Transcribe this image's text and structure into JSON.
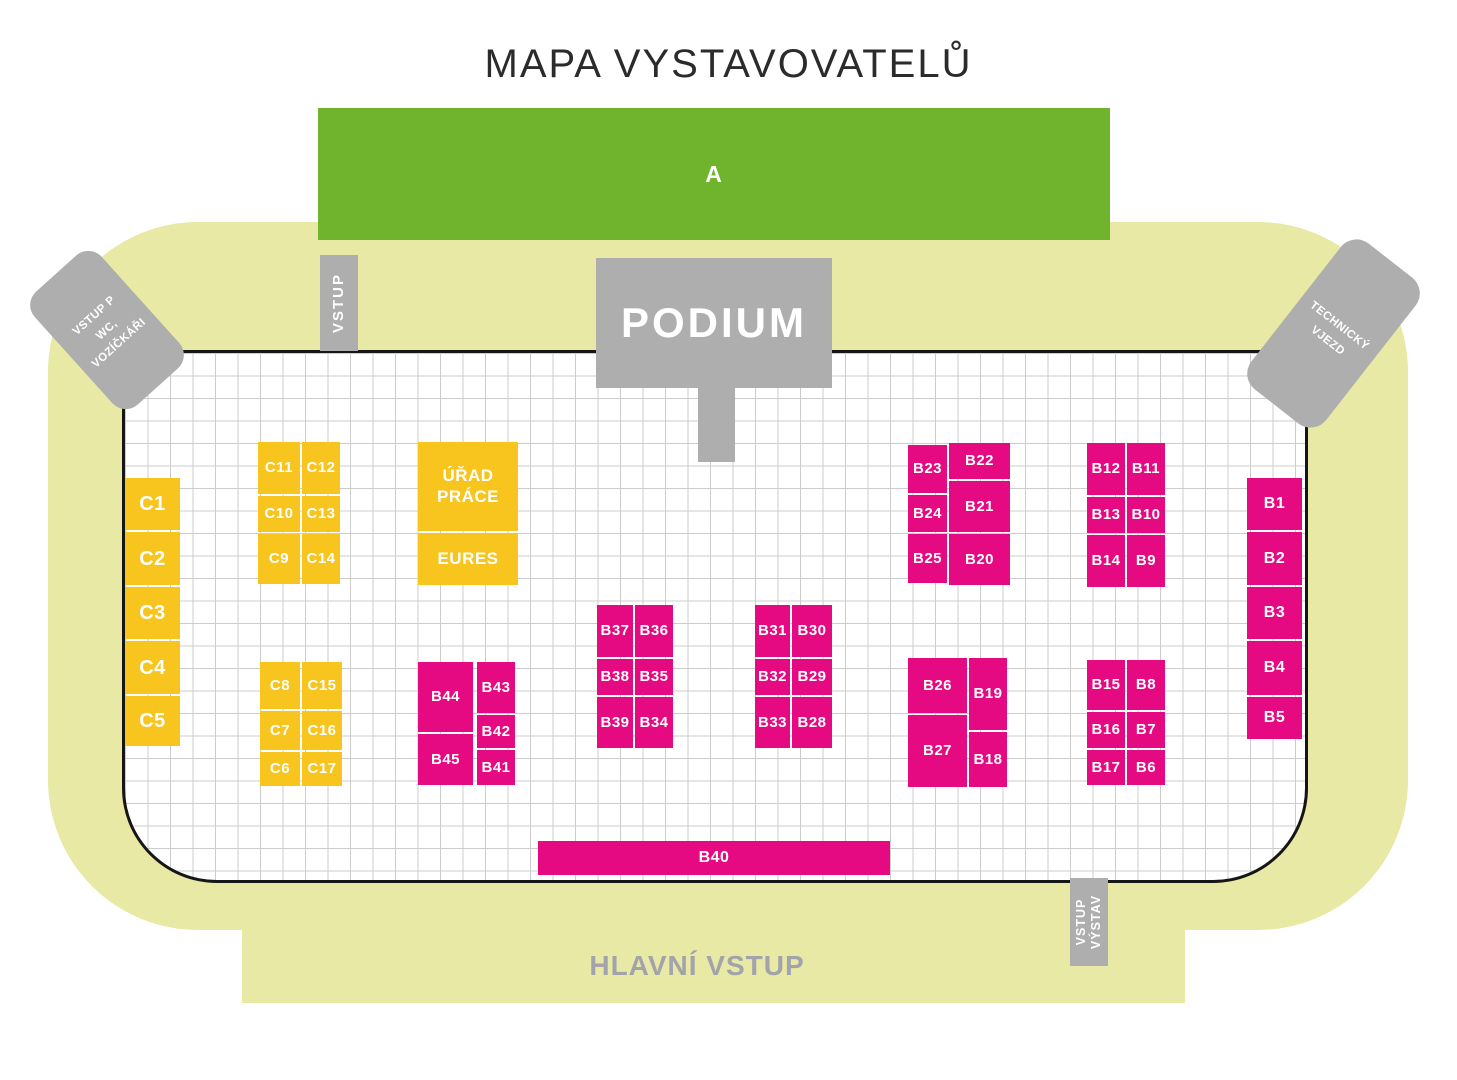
{
  "title": "MAPA VYSTAVOVATELŮ",
  "colors": {
    "hall_green": "#6fb42c",
    "booth_pink": "#e50a81",
    "booth_yellow": "#f8c41e",
    "venue_background": "#e7e9a4",
    "structure_gray": "#aeaeae",
    "grid_line": "#cccccc",
    "floor_border": "#161616",
    "main_entrance_text": "#a2a3ab"
  },
  "zones": {
    "hall_a_label": "A",
    "podium_label": "PODIUM"
  },
  "entrances": {
    "wheelchair_line1": "VSTUP P",
    "wheelchair_line2": "WC, VOZÍČKÁŘI",
    "technical_line1": "TECHNICKÝ",
    "technical_line2": "VJEZD",
    "side_top": "VSTUP",
    "exhibitor_line1": "VSTUP",
    "exhibitor_line2": "VÝSTAV",
    "main": "HLAVNÍ VSTUP"
  },
  "booths": [
    {
      "id": "C1",
      "color": "yellow",
      "x": 125,
      "y": 478,
      "w": 55,
      "h": 52,
      "fs": 20
    },
    {
      "id": "C2",
      "color": "yellow",
      "x": 125,
      "y": 532,
      "w": 55,
      "h": 53,
      "fs": 20
    },
    {
      "id": "C3",
      "color": "yellow",
      "x": 125,
      "y": 587,
      "w": 55,
      "h": 52,
      "fs": 20
    },
    {
      "id": "C4",
      "color": "yellow",
      "x": 125,
      "y": 641,
      "w": 55,
      "h": 53,
      "fs": 20
    },
    {
      "id": "C5",
      "color": "yellow",
      "x": 125,
      "y": 696,
      "w": 55,
      "h": 50,
      "fs": 20
    },
    {
      "id": "C11",
      "color": "yellow",
      "x": 258,
      "y": 442,
      "w": 42,
      "h": 52,
      "fs": 15
    },
    {
      "id": "C12",
      "color": "yellow",
      "x": 302,
      "y": 442,
      "w": 38,
      "h": 52,
      "fs": 15
    },
    {
      "id": "C10",
      "color": "yellow",
      "x": 258,
      "y": 496,
      "w": 42,
      "h": 36,
      "fs": 15
    },
    {
      "id": "C13",
      "color": "yellow",
      "x": 302,
      "y": 496,
      "w": 38,
      "h": 36,
      "fs": 15
    },
    {
      "id": "C9",
      "color": "yellow",
      "x": 258,
      "y": 534,
      "w": 42,
      "h": 50,
      "fs": 15
    },
    {
      "id": "C14",
      "color": "yellow",
      "x": 302,
      "y": 534,
      "w": 38,
      "h": 50,
      "fs": 15
    },
    {
      "id": "URAD-PRACE",
      "label": "ÚŘAD\nPRÁCE",
      "color": "yellow",
      "x": 418,
      "y": 442,
      "w": 100,
      "h": 89,
      "fs": 17
    },
    {
      "id": "EURES",
      "label": "EURES",
      "color": "yellow",
      "x": 418,
      "y": 533,
      "w": 100,
      "h": 52,
      "fs": 17
    },
    {
      "id": "C8",
      "color": "yellow",
      "x": 260,
      "y": 662,
      "w": 40,
      "h": 47,
      "fs": 15
    },
    {
      "id": "C15",
      "color": "yellow",
      "x": 302,
      "y": 662,
      "w": 40,
      "h": 47,
      "fs": 15
    },
    {
      "id": "C7",
      "color": "yellow",
      "x": 260,
      "y": 711,
      "w": 40,
      "h": 39,
      "fs": 15
    },
    {
      "id": "C16",
      "color": "yellow",
      "x": 302,
      "y": 711,
      "w": 40,
      "h": 39,
      "fs": 15
    },
    {
      "id": "C6",
      "color": "yellow",
      "x": 260,
      "y": 752,
      "w": 40,
      "h": 34,
      "fs": 15
    },
    {
      "id": "C17",
      "color": "yellow",
      "x": 302,
      "y": 752,
      "w": 40,
      "h": 34,
      "fs": 15
    },
    {
      "id": "B44",
      "color": "pink",
      "x": 418,
      "y": 662,
      "w": 55,
      "h": 70,
      "fs": 15
    },
    {
      "id": "B45",
      "color": "pink",
      "x": 418,
      "y": 734,
      "w": 55,
      "h": 51,
      "fs": 15
    },
    {
      "id": "B43",
      "color": "pink",
      "x": 477,
      "y": 662,
      "w": 38,
      "h": 51,
      "fs": 15
    },
    {
      "id": "B42",
      "color": "pink",
      "x": 477,
      "y": 715,
      "w": 38,
      "h": 33,
      "fs": 15
    },
    {
      "id": "B41",
      "color": "pink",
      "x": 477,
      "y": 750,
      "w": 38,
      "h": 35,
      "fs": 15
    },
    {
      "id": "B37",
      "color": "pink",
      "x": 597,
      "y": 605,
      "w": 36,
      "h": 52,
      "fs": 15
    },
    {
      "id": "B36",
      "color": "pink",
      "x": 635,
      "y": 605,
      "w": 38,
      "h": 52,
      "fs": 15
    },
    {
      "id": "B38",
      "color": "pink",
      "x": 597,
      "y": 659,
      "w": 36,
      "h": 36,
      "fs": 15
    },
    {
      "id": "B35",
      "color": "pink",
      "x": 635,
      "y": 659,
      "w": 38,
      "h": 36,
      "fs": 15
    },
    {
      "id": "B39",
      "color": "pink",
      "x": 597,
      "y": 697,
      "w": 36,
      "h": 51,
      "fs": 15
    },
    {
      "id": "B34",
      "color": "pink",
      "x": 635,
      "y": 697,
      "w": 38,
      "h": 51,
      "fs": 15
    },
    {
      "id": "B31",
      "color": "pink",
      "x": 755,
      "y": 605,
      "w": 35,
      "h": 52,
      "fs": 15
    },
    {
      "id": "B30",
      "color": "pink",
      "x": 792,
      "y": 605,
      "w": 40,
      "h": 52,
      "fs": 15
    },
    {
      "id": "B32",
      "color": "pink",
      "x": 755,
      "y": 659,
      "w": 35,
      "h": 36,
      "fs": 15
    },
    {
      "id": "B29",
      "color": "pink",
      "x": 792,
      "y": 659,
      "w": 40,
      "h": 36,
      "fs": 15
    },
    {
      "id": "B33",
      "color": "pink",
      "x": 755,
      "y": 697,
      "w": 35,
      "h": 51,
      "fs": 15
    },
    {
      "id": "B28",
      "color": "pink",
      "x": 792,
      "y": 697,
      "w": 40,
      "h": 51,
      "fs": 15
    },
    {
      "id": "B23",
      "color": "pink",
      "x": 908,
      "y": 445,
      "w": 39,
      "h": 48,
      "fs": 15
    },
    {
      "id": "B22",
      "color": "pink",
      "x": 949,
      "y": 443,
      "w": 61,
      "h": 36,
      "fs": 15
    },
    {
      "id": "B24",
      "color": "pink",
      "x": 908,
      "y": 495,
      "w": 39,
      "h": 37,
      "fs": 15
    },
    {
      "id": "B21",
      "color": "pink",
      "x": 949,
      "y": 481,
      "w": 61,
      "h": 51,
      "fs": 15
    },
    {
      "id": "B25",
      "color": "pink",
      "x": 908,
      "y": 534,
      "w": 39,
      "h": 49,
      "fs": 15
    },
    {
      "id": "B20",
      "color": "pink",
      "x": 949,
      "y": 534,
      "w": 61,
      "h": 51,
      "fs": 15
    },
    {
      "id": "B26",
      "color": "pink",
      "x": 908,
      "y": 658,
      "w": 59,
      "h": 55,
      "fs": 15
    },
    {
      "id": "B19",
      "color": "pink",
      "x": 969,
      "y": 658,
      "w": 38,
      "h": 72,
      "fs": 15
    },
    {
      "id": "B27",
      "color": "pink",
      "x": 908,
      "y": 715,
      "w": 59,
      "h": 72,
      "fs": 15
    },
    {
      "id": "B18",
      "color": "pink",
      "x": 969,
      "y": 732,
      "w": 38,
      "h": 55,
      "fs": 15
    },
    {
      "id": "B12",
      "color": "pink",
      "x": 1087,
      "y": 443,
      "w": 38,
      "h": 52,
      "fs": 15
    },
    {
      "id": "B11",
      "color": "pink",
      "x": 1127,
      "y": 443,
      "w": 38,
      "h": 52,
      "fs": 15
    },
    {
      "id": "B13",
      "color": "pink",
      "x": 1087,
      "y": 497,
      "w": 38,
      "h": 36,
      "fs": 15
    },
    {
      "id": "B10",
      "color": "pink",
      "x": 1127,
      "y": 497,
      "w": 38,
      "h": 36,
      "fs": 15
    },
    {
      "id": "B14",
      "color": "pink",
      "x": 1087,
      "y": 535,
      "w": 38,
      "h": 52,
      "fs": 15
    },
    {
      "id": "B9",
      "color": "pink",
      "x": 1127,
      "y": 535,
      "w": 38,
      "h": 52,
      "fs": 15
    },
    {
      "id": "B15",
      "color": "pink",
      "x": 1087,
      "y": 660,
      "w": 38,
      "h": 50,
      "fs": 15
    },
    {
      "id": "B8",
      "color": "pink",
      "x": 1127,
      "y": 660,
      "w": 38,
      "h": 50,
      "fs": 15
    },
    {
      "id": "B16",
      "color": "pink",
      "x": 1087,
      "y": 712,
      "w": 38,
      "h": 36,
      "fs": 15
    },
    {
      "id": "B7",
      "color": "pink",
      "x": 1127,
      "y": 712,
      "w": 38,
      "h": 36,
      "fs": 15
    },
    {
      "id": "B17",
      "color": "pink",
      "x": 1087,
      "y": 750,
      "w": 38,
      "h": 35,
      "fs": 15
    },
    {
      "id": "B6",
      "color": "pink",
      "x": 1127,
      "y": 750,
      "w": 38,
      "h": 35,
      "fs": 15
    },
    {
      "id": "B1",
      "color": "pink",
      "x": 1247,
      "y": 478,
      "w": 55,
      "h": 52,
      "fs": 16
    },
    {
      "id": "B2",
      "color": "pink",
      "x": 1247,
      "y": 532,
      "w": 55,
      "h": 53,
      "fs": 16
    },
    {
      "id": "B3",
      "color": "pink",
      "x": 1247,
      "y": 587,
      "w": 55,
      "h": 52,
      "fs": 16
    },
    {
      "id": "B4",
      "color": "pink",
      "x": 1247,
      "y": 641,
      "w": 55,
      "h": 54,
      "fs": 16
    },
    {
      "id": "B5",
      "color": "pink",
      "x": 1247,
      "y": 697,
      "w": 55,
      "h": 42,
      "fs": 16
    },
    {
      "id": "B40",
      "color": "pink",
      "x": 538,
      "y": 841,
      "w": 352,
      "h": 34,
      "fs": 16
    }
  ]
}
